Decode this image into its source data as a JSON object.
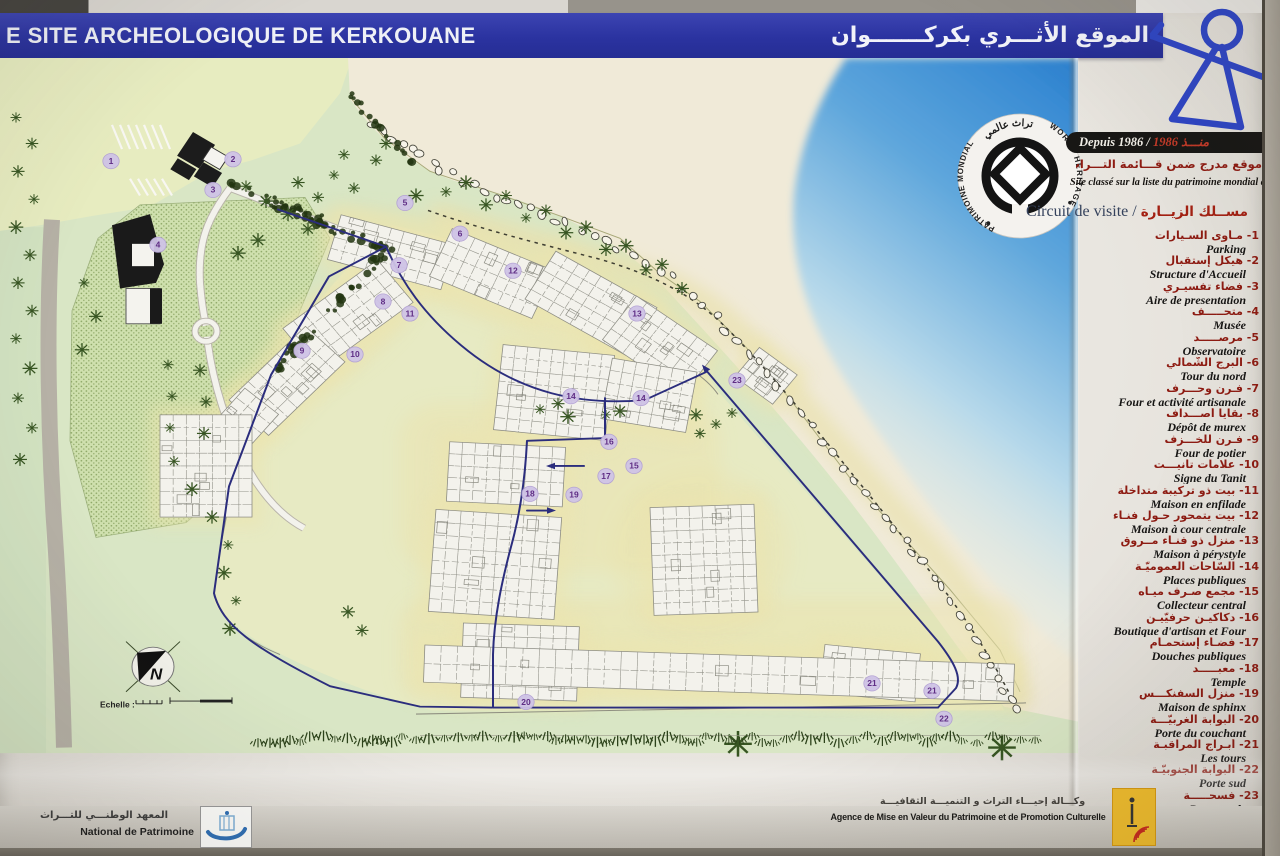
{
  "panel": {
    "title_fr": "E SITE ARCHEOLOGIQUE DE KERKOUANE",
    "title_ar": "الموقع الأثـــري بكركـــــــوان",
    "unesco": {
      "emblem_top_ar": "تراث عالمي",
      "emblem_left": "PATRIMOINE MONDIAL",
      "emblem_right": "WORLD HERITAGE",
      "since_fr": "Depuis 1986 / ",
      "since_ar": "1986 منـــذ",
      "listed_ar": "موقع مدرج ضمن قـــائمة التـــراث العـــالمي لليونسكـــو",
      "listed_fr": "Site classé sur la liste du patrimoine mondial de l'UNESCO"
    },
    "legend": {
      "heading_fr": "Circuit de visite / ",
      "heading_ar": "مســلك الزيــارة",
      "items": [
        {
          "n": 1,
          "ar": "مـأوى السـيارات",
          "fr": "Parking"
        },
        {
          "n": 2,
          "ar": "هيكل إستقبال",
          "fr": "Structure d'Accueil"
        },
        {
          "n": 3,
          "ar": "فضاء تفسيـري",
          "fr": "Aire de presentation"
        },
        {
          "n": 4,
          "ar": "متحـــــف",
          "fr": "Musée"
        },
        {
          "n": 5,
          "ar": "مرصـــــد",
          "fr": "Observatoire"
        },
        {
          "n": 6,
          "ar": "البرج الشّمالي",
          "fr": "Tour du nord"
        },
        {
          "n": 7,
          "ar": "فـرن وحـــرف",
          "fr": "Four et activité artisanale"
        },
        {
          "n": 8,
          "ar": "بقايا أصـــداف",
          "fr": "Dépôt de murex"
        },
        {
          "n": 9,
          "ar": "فـرن للخـــزف",
          "fr": "Four de potier"
        },
        {
          "n": 10,
          "ar": "علامات تانيـــت",
          "fr": "Signe du Tanit"
        },
        {
          "n": 11,
          "ar": "بيت ذو تركيبة متداخلة",
          "fr": "Maison en enfilade"
        },
        {
          "n": 12,
          "ar": "بيت يتمحور حـول فنـاء",
          "fr": "Maison à cour centrale"
        },
        {
          "n": 13,
          "ar": "منزل ذو فنـاء مــروق",
          "fr": "Maison à pérystyle"
        },
        {
          "n": 14,
          "ar": "السّاحات العموميّـة",
          "fr": "Places publiques"
        },
        {
          "n": 15,
          "ar": "مجمع صـرف ميـاه",
          "fr": "Collecteur central"
        },
        {
          "n": 16,
          "ar": "دكاكيـن حرفيّيـن",
          "fr": "Boutique d'artisan et Four"
        },
        {
          "n": 17,
          "ar": "فضـاء إستحمـام",
          "fr": "Douches publiques"
        },
        {
          "n": 18,
          "ar": "معبـــــد",
          "fr": "Temple"
        },
        {
          "n": 19,
          "ar": "منزل السفنكـــس",
          "fr": "Maison de sphinx"
        },
        {
          "n": 20,
          "ar": "البوابة الغربيّـــة",
          "fr": "Porte du couchant"
        },
        {
          "n": 21,
          "ar": "أبـراج المراقبـة",
          "fr": "Les tours"
        },
        {
          "n": 22,
          "ar": "البوابة الجنوبيّـة",
          "fr": "Porte sud"
        },
        {
          "n": 23,
          "ar": "فسحـــــة",
          "fr": "Promenade"
        }
      ]
    },
    "map": {
      "scale_label": "Echelle :",
      "north_letter": "N",
      "markers": [
        {
          "n": "1",
          "x": 111,
          "y": 169
        },
        {
          "n": "2",
          "x": 233,
          "y": 167
        },
        {
          "n": "3",
          "x": 213,
          "y": 200
        },
        {
          "n": "4",
          "x": 158,
          "y": 259
        },
        {
          "n": "5",
          "x": 405,
          "y": 214
        },
        {
          "n": "6",
          "x": 460,
          "y": 247
        },
        {
          "n": "7",
          "x": 399,
          "y": 281
        },
        {
          "n": "8",
          "x": 383,
          "y": 320
        },
        {
          "n": "9",
          "x": 302,
          "y": 373
        },
        {
          "n": "10",
          "x": 355,
          "y": 377
        },
        {
          "n": "11",
          "x": 410,
          "y": 333
        },
        {
          "n": "12",
          "x": 513,
          "y": 287
        },
        {
          "n": "13",
          "x": 637,
          "y": 333
        },
        {
          "n": "14",
          "x": 571,
          "y": 422
        },
        {
          "n": "14",
          "x": 641,
          "y": 424
        },
        {
          "n": "15",
          "x": 634,
          "y": 497
        },
        {
          "n": "16",
          "x": 609,
          "y": 471
        },
        {
          "n": "17",
          "x": 606,
          "y": 508
        },
        {
          "n": "18",
          "x": 530,
          "y": 527
        },
        {
          "n": "19",
          "x": 574,
          "y": 528
        },
        {
          "n": "20",
          "x": 526,
          "y": 751
        },
        {
          "n": "21",
          "x": 872,
          "y": 731
        },
        {
          "n": "21",
          "x": 932,
          "y": 739
        },
        {
          "n": "22",
          "x": 944,
          "y": 769
        },
        {
          "n": "23",
          "x": 737,
          "y": 405
        }
      ]
    },
    "footer": {
      "inp_ar": "المعهد الوطنـــي للتـــراث",
      "inp_fr": "National de Patrimoine",
      "amv_ar": "وكـــالة إحيـــاء التراث و التنميـــة الثقافيـــة",
      "amv_fr": "Agence de Mise en Valeur du Patrimoine et de Promotion Culturelle"
    },
    "colors": {
      "banner_blue": "#2b33a0",
      "sea_blue": "#2b81d0",
      "land_green": "#d9e6c5",
      "site_cream": "#e8eac2",
      "circuit_navy": "#2b2d7d",
      "legend_red": "#8e1b12",
      "marker_purple": "#5f2d85"
    }
  }
}
